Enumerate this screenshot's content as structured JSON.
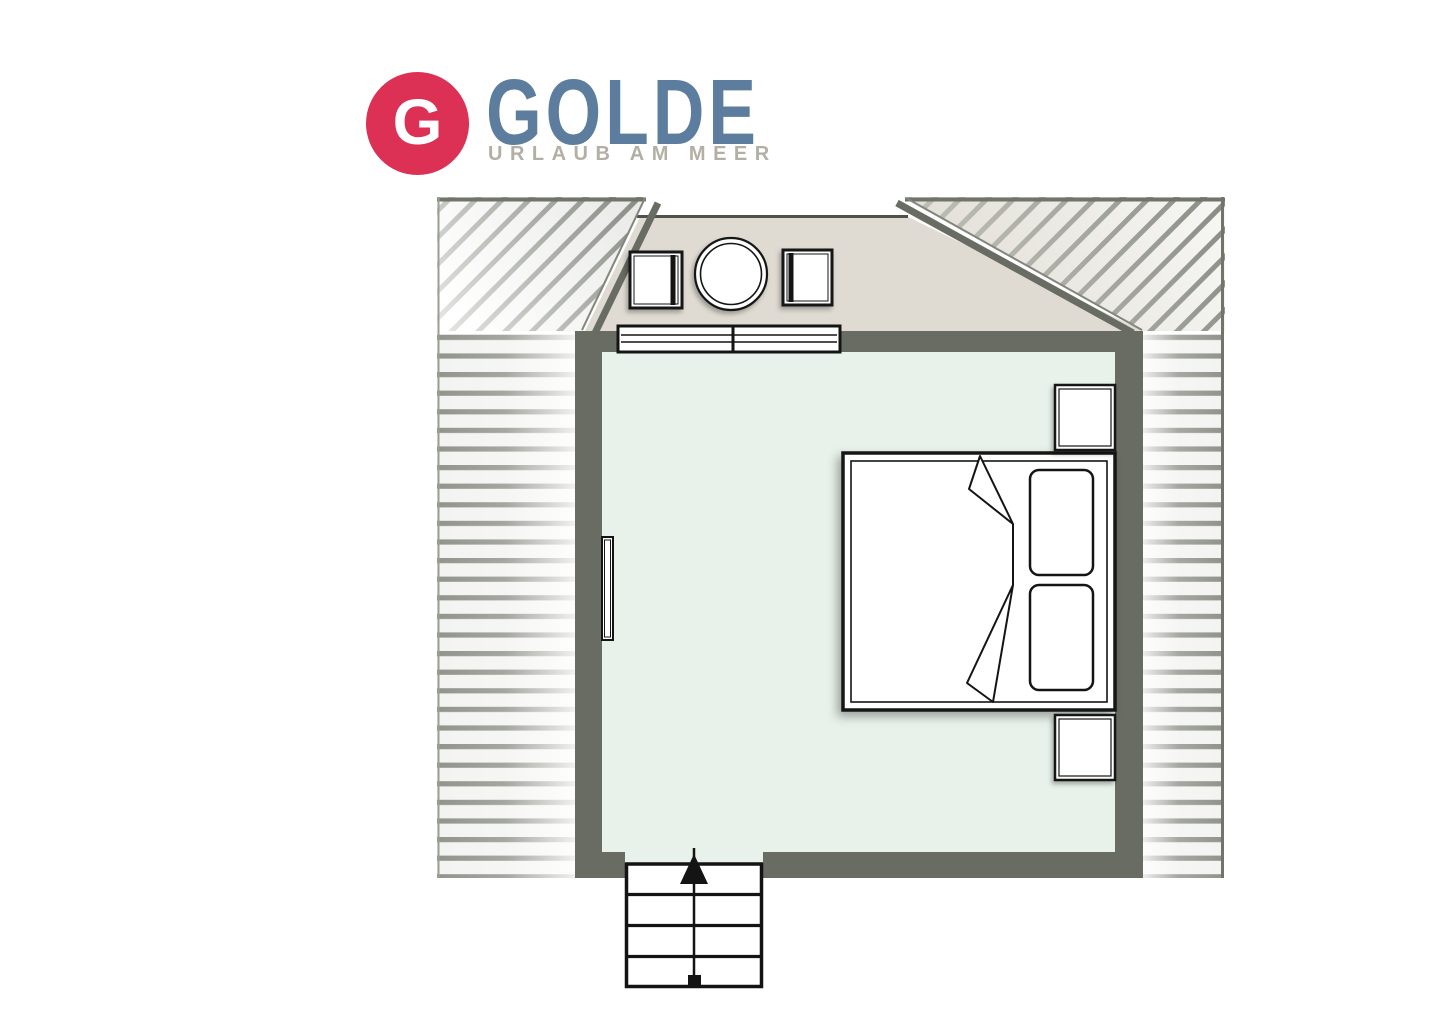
{
  "logo": {
    "monogram": "G",
    "brand": "GOLDE",
    "tagline": "URLAUB AM MEER"
  },
  "colors": {
    "brand_red": "#dc3055",
    "brand_blue": "#5c7d9e",
    "tagline_gray": "#b3afa5",
    "wall": "#686c62",
    "floor": "#e8f2ea",
    "dormer": "#dfdbd2",
    "ink": "#141414",
    "hatch": "#878b82",
    "stripe": "#90948b",
    "stripe_bg": "#f3f3f1"
  },
  "floorplan": {
    "kind": "attic-bedroom-floor-plan",
    "roof": {
      "hatched_slope_areas": 4,
      "dormer": 1
    },
    "furniture": {
      "double_bed": {
        "pillows": 2,
        "duvet_fold": true
      },
      "nightstands": 2,
      "chairs": 2,
      "round_table": 1,
      "radiator": 1,
      "window_panes": 2
    },
    "stairs": {
      "treads": 4,
      "direction_arrow": "up",
      "start_marker": "square"
    }
  }
}
